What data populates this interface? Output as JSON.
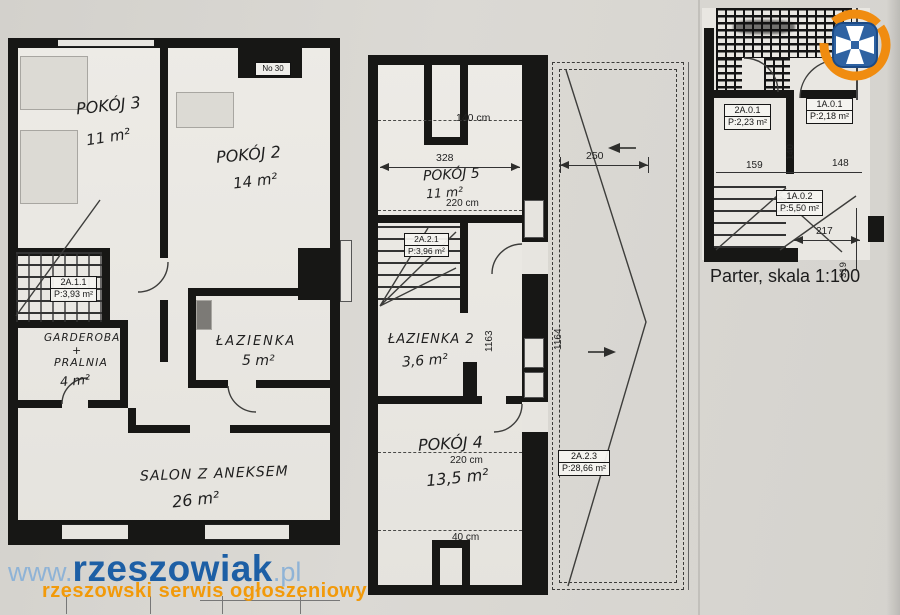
{
  "watermark": {
    "prefix": "www.",
    "brand": "rzeszowiak",
    "suffix": ".pl",
    "tagline": "rzeszowski serwis ogłoszeniowy"
  },
  "colors": {
    "brand_blue": "#1d5fa5",
    "brand_blue_light": "#8fb3d6",
    "brand_orange": "#f29a0a",
    "logo_square_blue": "#2e62a2",
    "logo_swirl_orange": "#f08c10",
    "ink": "#1a1a1a"
  },
  "plan_left": {
    "tag": "No 30",
    "pokoj3_name": "POKÓJ 3",
    "pokoj3_area": "11 m²",
    "pokoj2_name": "POKÓJ 2",
    "pokoj2_area": "14 m²",
    "stair_id": "2A.1.1",
    "stair_area": "P:3,93 m²",
    "garderoba_l1": "GARDEROBA",
    "garderoba_l2": "+",
    "garderoba_l3": "PRALNIA",
    "garderoba_area": "4 m²",
    "lazienka_name": "ŁAZIENKA",
    "lazienka_area": "5 m²",
    "salon_name": "SALON Z ANEKSEM",
    "salon_area": "26 m²"
  },
  "plan_middle": {
    "dim_top": "140 cm",
    "dim_328": "328",
    "pokoj5_name": "POKÓJ 5",
    "pokoj5_area": "11 m²",
    "dim_220_top": "220 cm",
    "stair_id": "2A.2.1",
    "stair_area": "P:3,96 m²",
    "dim_1163": "1163",
    "lazienka2_name": "ŁAZIENKA 2",
    "lazienka2_area": "3,6 m²",
    "pokoj4_name": "POKÓJ 4",
    "dim_220_bottom": "220 cm",
    "pokoj4_area": "13,5 m²",
    "dim_bottom": "40 cm",
    "dim_250": "250",
    "dim_1164": "1164",
    "attic_id": "2A.2.3",
    "attic_area": "P:28,66 m²"
  },
  "plan_right": {
    "r2a01_id": "2A.0.1",
    "r2a01_area": "P:2,23 m²",
    "r1a01_id": "1A.0.1",
    "r1a01_area": "P:2,18 m²",
    "dim_159": "159",
    "dim_140": "140",
    "dim_148": "148",
    "r1a02_id": "1A.0.2",
    "r1a02_area": "P:5,50 m²",
    "dim_217": "217",
    "dim_319": "319",
    "caption": "Parter, skala 1:100"
  }
}
